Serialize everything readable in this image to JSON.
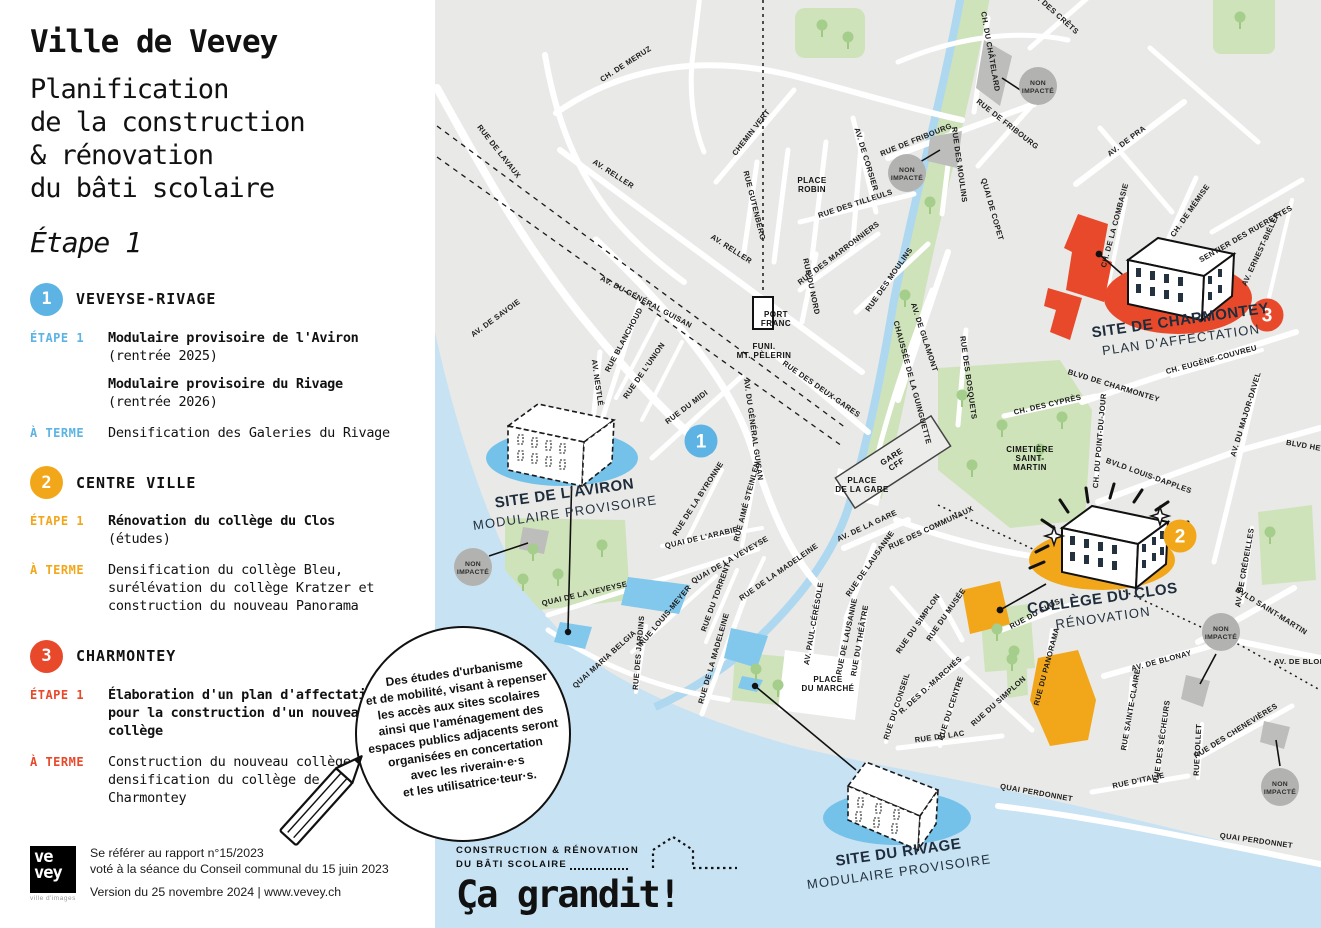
{
  "sidebar": {
    "title": "Ville de Vevey",
    "subtitle_lines": [
      "Planification",
      "de la construction",
      "& rénovation",
      "du bâti scolaire"
    ],
    "stage": "Étape 1",
    "sections": [
      {
        "num": "1",
        "name": "VEVEYSE-RIVAGE",
        "color": "#5cb3e4",
        "rows": [
          {
            "label": "ÉTAPE 1",
            "items": [
              {
                "bold": "Modulaire provisoire de l'Aviron",
                "note": "(rentrée 2025)"
              },
              {
                "bold": "Modulaire provisoire du Rivage",
                "note": "(rentrée 2026)"
              }
            ]
          },
          {
            "label": "À TERME",
            "items": [
              {
                "text": "Densification des Galeries du Rivage"
              }
            ]
          }
        ]
      },
      {
        "num": "2",
        "name": "CENTRE VILLE",
        "color": "#f2a71b",
        "rows": [
          {
            "label": "ÉTAPE 1",
            "items": [
              {
                "bold": "Rénovation du collège du Clos",
                "note": "(études)"
              }
            ]
          },
          {
            "label": "À TERME",
            "items": [
              {
                "text": "Densification du collège Bleu, surélévation du collège Kratzer et construction du nouveau Panorama"
              }
            ]
          }
        ]
      },
      {
        "num": "3",
        "name": "CHARMONTEY",
        "color": "#e8492b",
        "rows": [
          {
            "label": "ÉTAPE 1",
            "items": [
              {
                "bold": "Élaboration d'un plan d'affectation pour la construction d'un nouveau collège"
              }
            ]
          },
          {
            "label": "À TERME",
            "items": [
              {
                "text": "Construction du nouveau collège et densification du collège de Charmontey"
              }
            ]
          }
        ]
      }
    ],
    "footer": {
      "logo_line1": "ve",
      "logo_line2": "vey",
      "logo_tagline": "ville d'images",
      "line1": "Se référer au rapport n°15/2023",
      "line2": "voté à la séance du Conseil communal du 15 juin 2023",
      "version": "Version du 25 novembre 2024 | www.vevey.ch"
    }
  },
  "bubble": {
    "lines": [
      "Des études d'urbanisme",
      "et de mobilité, visant à repenser",
      "les accès aux sites scolaires",
      "ainsi que l'aménagement des",
      "espaces publics adjacents seront",
      "organisées en concertation",
      "avec les riverain·e·s",
      "et les utilisatrice·teur·s."
    ]
  },
  "grandit": {
    "line1": "CONSTRUCTION & RÉNOVATION",
    "line2": "DU BÂTI SCOLAIRE",
    "slogan": "Ça grandit!"
  },
  "palette": {
    "blue": "#5cb3e4",
    "blue_site": "#74c2ea",
    "orange": "#f2a71b",
    "red": "#e8492b",
    "water": "#c7e2f3",
    "land": "#e9e9e7",
    "park": "#cfe3ba",
    "gray_badge": "#b2b2b0"
  },
  "map": {
    "markers": [
      {
        "n": "1",
        "x": 701,
        "y": 441,
        "color": "#5cb3e4"
      },
      {
        "n": "2",
        "x": 1180,
        "y": 536,
        "color": "#f2a71b"
      },
      {
        "n": "3",
        "x": 1267,
        "y": 315,
        "color": "#e8492b"
      }
    ],
    "non_impacte": {
      "label": [
        "NON",
        "IMPACTÉ"
      ],
      "positions": [
        [
          1038,
          86
        ],
        [
          907,
          173
        ],
        [
          473,
          567
        ],
        [
          1221,
          632
        ],
        [
          1280,
          787
        ]
      ]
    },
    "sites": [
      {
        "name": "SITE DE L'AVIRON",
        "subtitle": "MODULAIRE PROVISOIRE",
        "x": 565,
        "y": 498,
        "rot": -8
      },
      {
        "name": "COLLÈGE DU CLOS",
        "subtitle": "RÉNOVATION",
        "x": 1103,
        "y": 603,
        "rot": -8
      },
      {
        "name": "SITE DE CHARMONTEY",
        "subtitle": "PLAN D'AFFECTATION",
        "x": 1181,
        "y": 325,
        "rot": -8
      },
      {
        "name": "SITE DU RIVAGE",
        "subtitle": "MODULAIRE PROVISOIRE",
        "x": 899,
        "y": 857,
        "rot": -8
      }
    ],
    "places": [
      {
        "lines": [
          "FUNI.",
          "MT. PÈLERIN"
        ],
        "x": 764,
        "y": 349,
        "rot": 0
      },
      {
        "lines": [
          "PLACE",
          "ROBIN"
        ],
        "x": 812,
        "y": 183,
        "rot": 0
      },
      {
        "lines": [
          "PORT",
          "FRANC"
        ],
        "x": 776,
        "y": 317,
        "rot": 0
      },
      {
        "lines": [
          "GARE",
          "CFF"
        ],
        "x": 893,
        "y": 459,
        "rot": -33
      },
      {
        "lines": [
          "PLACE",
          "DE LA GARE"
        ],
        "x": 862,
        "y": 483,
        "rot": 0
      },
      {
        "lines": [
          "CIMETIÈRE",
          "SAINT-",
          "MARTIN"
        ],
        "x": 1030,
        "y": 452,
        "rot": 0
      },
      {
        "lines": [
          "PLACE",
          "DU MARCHÉ"
        ],
        "x": 828,
        "y": 682,
        "rot": 0
      }
    ],
    "street_labels": [
      [
        "RUE DE LAVAUX",
        497,
        153,
        52
      ],
      [
        "CH. DE MERUZ",
        627,
        66,
        -33
      ],
      [
        "CHEMIN VERT",
        753,
        134,
        -52
      ],
      [
        "AV. RELLER",
        612,
        176,
        33
      ],
      [
        "AV. RELLER",
        730,
        251,
        33
      ],
      [
        "RUE GUTENBERG",
        752,
        206,
        76
      ],
      [
        "RUE DES TILLEULS",
        856,
        206,
        -18
      ],
      [
        "AV. DE CORSIER",
        864,
        160,
        73
      ],
      [
        "AV. DES CRÊTS",
        1053,
        14,
        42
      ],
      [
        "CH. DU CHÂTELARD",
        988,
        52,
        80
      ],
      [
        "RUE DE FRIBOURG",
        917,
        142,
        -22
      ],
      [
        "RUE DE FRIBOURG",
        1006,
        126,
        38
      ],
      [
        "RUE DES MOULINS",
        957,
        165,
        82
      ],
      [
        "QUAI DE COPET",
        990,
        210,
        74
      ],
      [
        "AV. DE PRA",
        1128,
        143,
        -37
      ],
      [
        "CH. DE MÉMISE",
        1192,
        212,
        -55
      ],
      [
        "SENTIER DES RUERETTES",
        1247,
        236,
        -30
      ],
      [
        "AV. ERNEST-BIÉLER",
        1263,
        250,
        -65
      ],
      [
        "CH. DE LA COMBASIE",
        1117,
        226,
        -75
      ],
      [
        "CH. EUGÈNE-COUVREU",
        1212,
        362,
        -15
      ],
      [
        "BLVD DE CHARMONTEY",
        1113,
        388,
        17
      ],
      [
        "CH. DU POINT-DU-JOUR",
        1102,
        441,
        -85
      ],
      [
        "BVLD LOUIS-DAPPLES",
        1148,
        478,
        20
      ],
      [
        "AV. DU MAJOR-DAVEL",
        1248,
        415,
        -73
      ],
      [
        "BLVD HENRI",
        1310,
        449,
        10
      ],
      [
        "CH. DES CYPRÈS",
        1048,
        407,
        -13
      ],
      [
        "AV. DE GILAMONT",
        922,
        338,
        72
      ],
      [
        "CHAUSSÉE DE LA GUINGUETTE",
        910,
        383,
        75
      ],
      [
        "RUE DES BOSQUETS",
        966,
        378,
        82
      ],
      [
        "RUE DES MARRONNIERS",
        840,
        255,
        -37
      ],
      [
        "RUE DU NORD",
        809,
        287,
        78
      ],
      [
        "RUE DES MOULINS",
        891,
        281,
        -55
      ],
      [
        "RUE DES DEUX-GARES",
        820,
        391,
        35
      ],
      [
        "AV. DU GÉNÉRAL GUISAN",
        645,
        304,
        28
      ],
      [
        "AV. DU GÉNÉRAL GUISAN",
        751,
        430,
        82
      ],
      [
        "AV. DE SAVOIE",
        497,
        320,
        -36
      ],
      [
        "RUE BLANCHOUD",
        626,
        341,
        -62
      ],
      [
        "AV. NESTLÉ",
        595,
        383,
        82
      ],
      [
        "RUE DE L'UNION",
        646,
        372,
        -55
      ],
      [
        "RUE DU MIDI",
        688,
        409,
        -37
      ],
      [
        "RUE DE LA BYRONNE",
        700,
        500,
        -57
      ],
      [
        "RUE AIMÉ STEINLEN",
        749,
        502,
        -75
      ],
      [
        "QUAI DE L'ARABIE",
        702,
        540,
        -13
      ],
      [
        "QUAI DE LA VEVEYSE",
        731,
        562,
        -30
      ],
      [
        "QUAI DE LA VEVEYSE",
        585,
        596,
        -13
      ],
      [
        "RUE DU TORRENT",
        718,
        598,
        -70
      ],
      [
        "RUE LOUIS-MEYER",
        667,
        617,
        -50
      ],
      [
        "RUE DES JARDINS",
        641,
        653,
        -85
      ],
      [
        "QUAI MARIA BELGIA",
        606,
        661,
        -42
      ],
      [
        "RUE DE LA MADELEINE",
        716,
        659,
        -74
      ],
      [
        "RUE DE LA MADELEINE",
        780,
        574,
        -35
      ],
      [
        "AV. PAUL-CÉRÉSOLE",
        816,
        624,
        -80
      ],
      [
        "RUE DE LAUSANNE",
        872,
        565,
        -55
      ],
      [
        "RUE DE LAUSANNE",
        849,
        637,
        -78
      ],
      [
        "RUE DU THÉÂTRE",
        862,
        641,
        -80
      ],
      [
        "RUE DU SIMPLON",
        920,
        625,
        -55
      ],
      [
        "RUE DU SIMPLON",
        1000,
        703,
        -42
      ],
      [
        "RUE DU MUSÉE",
        948,
        616,
        -55
      ],
      [
        "RUE DU CLOS",
        1036,
        616,
        -28
      ],
      [
        "RUE DU PANORAMA",
        1049,
        667,
        -75
      ],
      [
        "R. DES D.-MARCHÉS",
        932,
        687,
        -42
      ],
      [
        "RUE DU CONSEIL",
        899,
        707,
        -72
      ],
      [
        "RUE DU CENTRE",
        953,
        709,
        -72
      ],
      [
        "RUE DU LAC",
        940,
        739,
        -8
      ],
      [
        "QUAI PERDONNET",
        1036,
        795,
        10
      ],
      [
        "QUAI PERDONNET",
        1256,
        843,
        8
      ],
      [
        "RUE D'ITALIE",
        1139,
        783,
        -12
      ],
      [
        "RUE DES SÉCHEURS",
        1164,
        742,
        -82
      ],
      [
        "RUE COLLET",
        1200,
        750,
        -87
      ],
      [
        "RUE DES CHENEVIÈRES",
        1237,
        733,
        -32
      ],
      [
        "RUE SAINTE-CLAIRE",
        1133,
        710,
        -80
      ],
      [
        "AV. DE BLONAY",
        1162,
        663,
        -15
      ],
      [
        "AV. DE BLONAY",
        1305,
        664,
        0
      ],
      [
        "BVLD SAINT-MARTIN",
        1270,
        613,
        32
      ],
      [
        "AV. DE CRÉDEILLES",
        1247,
        568,
        -80
      ],
      [
        "RUE DES COMMUNAUX",
        932,
        530,
        -25
      ],
      [
        "AV. DE LA GARE",
        868,
        528,
        -25
      ]
    ]
  }
}
